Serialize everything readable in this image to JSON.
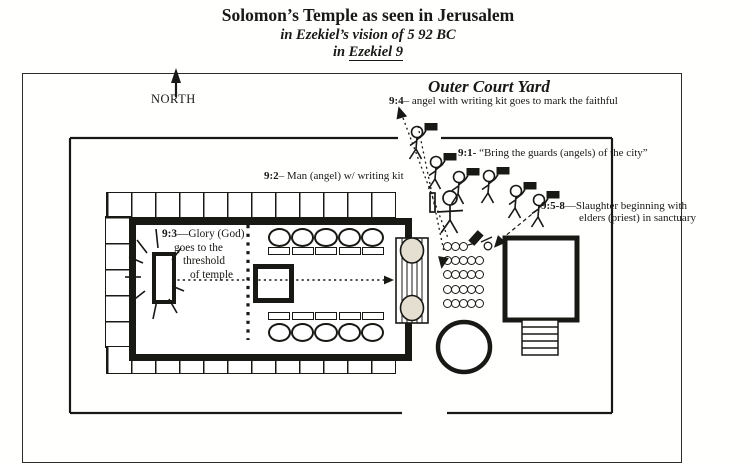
{
  "title": {
    "main": "Solomon’s Temple as seen in Jerusalem",
    "sub1": "in Ezekiel’s vision of 5 92 BC",
    "sub2_prefix": "in ",
    "sub2_ref": "Ezekiel 9"
  },
  "compass": {
    "north_label": "NORTH"
  },
  "outer_court": {
    "label": "Outer Court Yard"
  },
  "annotations": {
    "v94": {
      "ref": "9:4",
      "text": "– angel with writing kit goes to mark the faithful"
    },
    "v91": {
      "ref": "9:1-",
      "text": " “Bring the guards (angels) of the city”"
    },
    "v92": {
      "ref": "9:2",
      "text": "– Man (angel) w/ writing kit"
    },
    "v93": {
      "ref": "9:3",
      "line1": "—Glory (God)",
      "line2": "goes to the",
      "line3": "threshold",
      "line4": "of temple"
    },
    "v958": {
      "ref": "9:5-8",
      "line1": "—Slaughter beginning with",
      "line2": "elders (priest) in sanctuary"
    }
  },
  "colors": {
    "ink": "#181814",
    "paper": "#ffffff",
    "pillar_fill": "#e5dfd2"
  }
}
